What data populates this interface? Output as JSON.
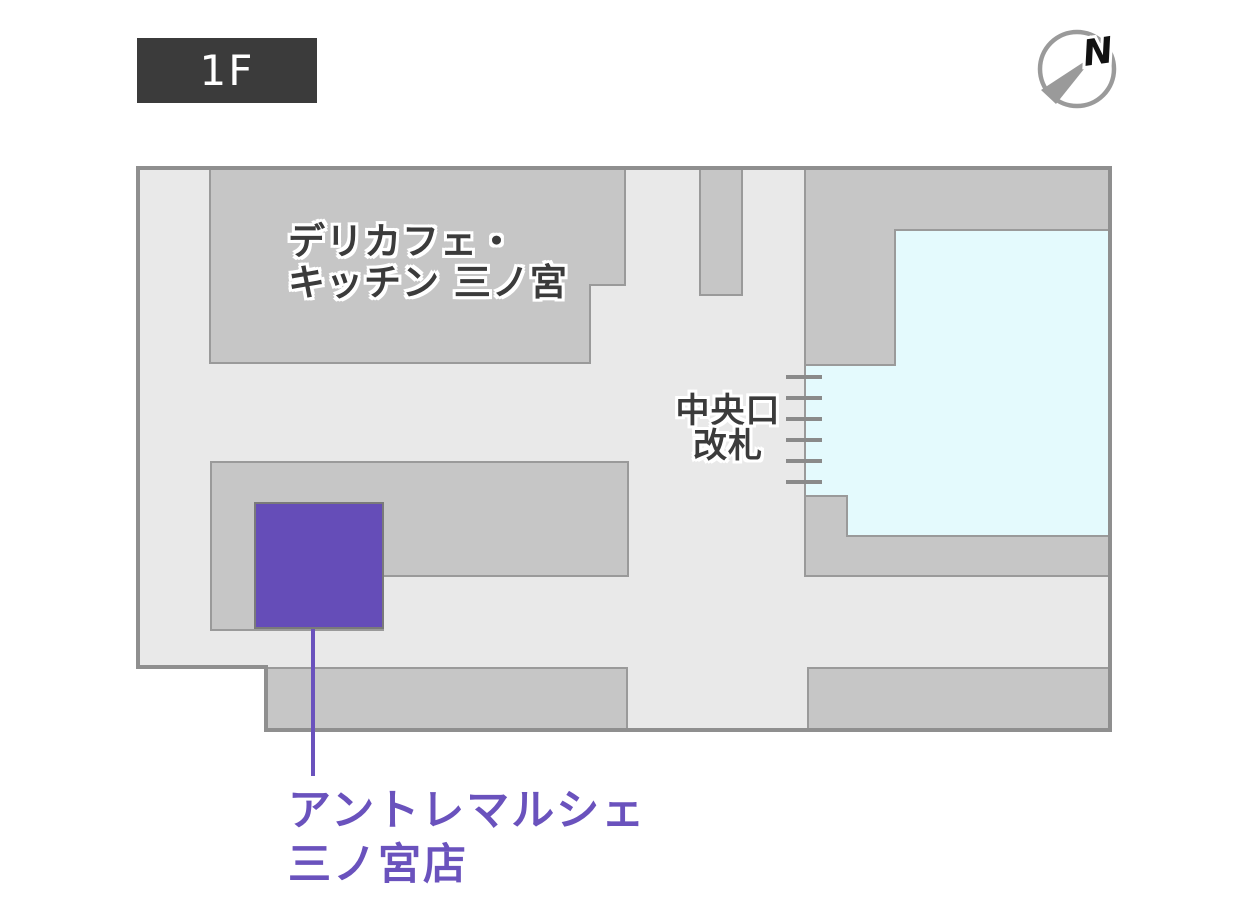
{
  "floor_badge": {
    "label": "1F"
  },
  "compass": {
    "north_label": "N"
  },
  "map": {
    "shop_delicafe": {
      "line1": "デリカフェ・",
      "line2": "キッチン 三ノ宮"
    },
    "central_gate": {
      "line1": "中央口",
      "line2": "改札"
    },
    "highlight_store": {
      "line1": "アントレマルシェ",
      "line2": "三ノ宮店"
    }
  },
  "colors": {
    "badge_bg": "#3b3b3b",
    "badge_text": "#ffffff",
    "floor": "#e9e9e9",
    "block": "#c6c6c6",
    "block_stroke": "#9a9a9a",
    "outline": "#8f8f8f",
    "paid_area": "#e4fafd",
    "store": "#654db8",
    "store_label": "#6a52bd",
    "map_label": "#3b3b3b",
    "gate_tick": "#8a8a8a",
    "compass": "#9a9a9a",
    "north": "#111111"
  }
}
